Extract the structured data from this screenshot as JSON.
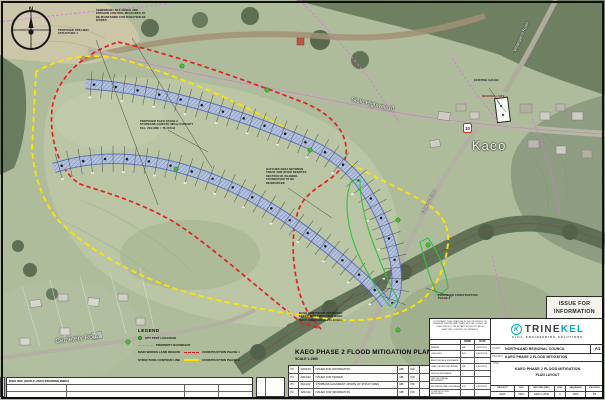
{
  "sheet": {
    "issue_line1": "ISSUE FOR",
    "issue_line2": "INFORMATION",
    "plan_title": "KAEO PHASE 2 FLOOD MITIGATION PLAN LAYOUT",
    "plan_scale": "SCALE 1:1500",
    "sheet_size": "A1"
  },
  "map": {
    "town": "Kaeo",
    "compass": "N",
    "shield": "10",
    "roads": {
      "sh10": "State Highway 10",
      "cemetery": "Cemetery Road",
      "omaunu": "Omaunu Road",
      "whangaroa": "Whangaroa Road"
    },
    "annotations": {
      "silt": "TEMPORARY SILT FENCE AND EROSION CONTROL MEASURES TO BE MAINTAINED FOR DURATION OF WORKS",
      "spillway": "PROPOSED SPILLWAY STRUCTURE 1",
      "stopbank": "PROPOSED KAEO STAGE 2 STOPBANK (LENGTH 480m) CONCEPT FILL VOLUME = 76,137m3",
      "hatched": "HATCHED AREA BETWEEN CREST AND RIVER DENOTES SECTION OF CHANNEL FOUNDATION TO BE REINFORCED",
      "armouring": "BANK ARMOURING PROPOSED KEYED INTO PROPOSED BANK. ROCK DIMENSIONS 200-300mm",
      "gauge": "EXISTING GAUGE",
      "memorial": "MEMORIAL SITE",
      "phase2": "PROPOSED CONSTRUCTION PHASE 2"
    }
  },
  "legend": {
    "title": "LEGEND",
    "cpt": "CPT TEST LOCATION",
    "property": "PROPERTY BOUNDARY",
    "works": "MAIN WORKS LAND REGION",
    "works_phase": "CONSTRUCTION PHASE 1",
    "structure": "STRUCTURE CONTOUR LINE",
    "structure_phase": "CONSTRUCTION PHASE 2"
  },
  "index_table": {
    "header": "DWG REF (KEW-C-2000) DRAWING INDEX"
  },
  "revisions": {
    "rows": [
      {
        "rev": "P5",
        "date": "03/02/23",
        "desc": "ISSUED FOR INFORMATION",
        "by": "MB",
        "chk": "KW",
        "app": "KW"
      },
      {
        "rev": "P4",
        "date": "20/12/22",
        "desc": "ISSUED FOR TENDER",
        "by": "MB",
        "chk": "KW",
        "app": "KW"
      },
      {
        "rev": "P3",
        "date": "04/11/22",
        "desc": "STOPBANK ALIGNMENT UPDATE OF STRUCTURES",
        "by": "MB",
        "chk": "KW",
        "app": "KW"
      },
      {
        "rev": "P2",
        "date": "12/10/22",
        "desc": "ISSUED FOR INFORMATION",
        "by": "MB",
        "chk": "KW",
        "app": "KW"
      }
    ]
  },
  "titleblock": {
    "copyright": "COPYRIGHT: THIS DRAWING IS THE PROPERTY OF TRINEKEL LIMITED AND SHALL NOT BE COPIED OR USED WHOLLY OR IN PART WITHOUT PRIOR WRITTEN CONSENT OF TRINEKEL",
    "name_col": "NAME",
    "date_col": "DATE",
    "rows": [
      {
        "role": "DRAWN",
        "name": "MB",
        "date": "03/02/2023"
      },
      {
        "role": "CHECKED",
        "name": "KW",
        "date": "03/02/2023"
      },
      {
        "role": "RESPONSIBLE ENGINEER",
        "name": "-",
        "date": "-"
      },
      {
        "role": "LEAD DESIGN REVIEWER",
        "name": "MB",
        "date": "03/02/2023"
      },
      {
        "role": "DESIGN ENGINEER",
        "name": "-",
        "date": "-"
      },
      {
        "role": "GEOTECHNICAL REVIEWER",
        "name": "-",
        "date": "-"
      },
      {
        "role": "PROFESSIONAL ENGINEER",
        "name": "KW",
        "date": "03/02/2023"
      },
      {
        "role": "CONSTRUCTION REVIEWER",
        "name": "-",
        "date": "-"
      }
    ],
    "brand": {
      "mark": "K",
      "name_a": "TRINE",
      "name_b": "KEL",
      "tagline": "CIVIL ENGINEERING SOLUTIONS"
    },
    "client_label": "CLIENT",
    "client": "NORTHLAND REGIONAL COUNCIL",
    "project_label": "PROJECT",
    "project": "KAEO PHASE 2 FLOOD MITIGATION",
    "title_label": "TITLE",
    "title_line1": "KAEO PHASE 2 FLOOD MITIGATION",
    "title_line2": "PLAN LAYOUT",
    "footer": {
      "h1": "PROJECT",
      "h2": "DOC",
      "h3": "RECORD (REF)",
      "h4": "DISC",
      "h5": "SEQUENCE",
      "h6": "REVISION",
      "v1": "KEW",
      "v2": "DRG",
      "v3": "KEW-C-2000",
      "v4": "C",
      "v5": "2000",
      "v6": "P5"
    }
  },
  "colors": {
    "phase1_red": "#e41b1b",
    "phase2_yellow": "#ffe400",
    "property_magenta": "#df6fdf",
    "brand_teal": "#00b2bd",
    "cpt_green": "#3dbf2f",
    "channel_blue": "#4f6ab8"
  }
}
